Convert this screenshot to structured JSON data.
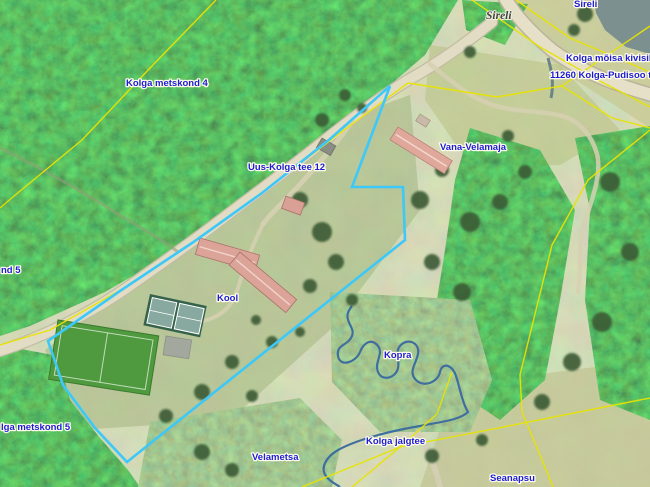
{
  "map": {
    "type": "aerial-orthophoto-with-cadastral-overlay",
    "region": "Kolga, Estonia",
    "labels": [
      {
        "id": "sireli-top",
        "text": "Sireli",
        "style": "cadastral-blue"
      },
      {
        "id": "sireli-landmark",
        "text": "Sireli",
        "style": "landmark-italic"
      },
      {
        "id": "kivisild",
        "text": "Kolga mõisa kivisild",
        "style": "cadastral-blue"
      },
      {
        "id": "pudisoo-tee",
        "text": "11260 Kolga-Pudisoo tee",
        "style": "cadastral-blue"
      },
      {
        "id": "metskond-4",
        "text": "Kolga metskond 4",
        "style": "cadastral-blue"
      },
      {
        "id": "uus-kolga-tee",
        "text": "Uus-Kolga tee 12",
        "style": "cadastral-blue"
      },
      {
        "id": "vana-velamaja",
        "text": "Vana-Velamaja",
        "style": "cadastral-blue"
      },
      {
        "id": "kool",
        "text": "Kool",
        "style": "cadastral-blue"
      },
      {
        "id": "kopra",
        "text": "Kopra",
        "style": "cadastral-blue"
      },
      {
        "id": "nd-5",
        "text": "nd 5",
        "style": "cadastral-blue-clipped"
      },
      {
        "id": "metskond-5",
        "text": "lga metskond 5",
        "style": "cadastral-blue-clipped"
      },
      {
        "id": "velametsa",
        "text": "Velametsa",
        "style": "cadastral-blue"
      },
      {
        "id": "kolga-jalgtee",
        "text": "Kolga jalgtee",
        "style": "cadastral-blue"
      },
      {
        "id": "seanapsu",
        "text": "Seanapsu",
        "style": "cadastral-blue"
      }
    ],
    "colors": {
      "parcel_highlight": "#3cc8f8",
      "cadastral_line": "#e8e400",
      "label_blue": "#1c1cd8",
      "water": "#3f6f9e",
      "road_fill": "#e6e0c8",
      "roof_salmon": "#dca498",
      "pitch_green": "#4f9a3e",
      "forest_green": "#30502e"
    }
  }
}
